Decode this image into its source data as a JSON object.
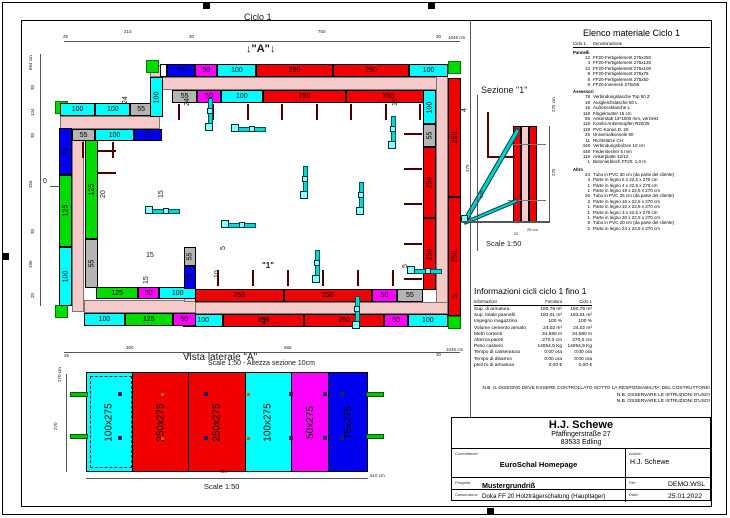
{
  "colors": {
    "red": "#f00000",
    "cyan": "#00ffff",
    "green": "#00dc00",
    "magenta": "#ff00ff",
    "blue": "#0000f0",
    "gray": "#b4b4b4",
    "white": "#ffffff"
  },
  "plan": {
    "title": "Ciclo 1",
    "bands": [
      {
        "x": 150,
        "y": 77,
        "w": 298,
        "h": 13
      },
      {
        "x": 436,
        "y": 65,
        "w": 12,
        "h": 252
      },
      {
        "x": 183,
        "y": 302,
        "w": 265,
        "h": 12
      },
      {
        "x": 72,
        "y": 116,
        "w": 12,
        "h": 196
      },
      {
        "x": 60,
        "y": 116,
        "w": 100,
        "h": 13
      },
      {
        "x": 84,
        "y": 300,
        "w": 112,
        "h": 13
      },
      {
        "x": 150,
        "y": 65,
        "w": 13,
        "h": 12
      },
      {
        "x": 184,
        "y": 289,
        "w": 12,
        "h": 13
      }
    ],
    "walls": [
      {
        "x": 160,
        "y": 64,
        "w": 288,
        "h": 13,
        "dir": "h",
        "segs": [
          {
            "s": 18,
            "c": "white",
            "t": ""
          },
          {
            "s": 75,
            "c": "blue",
            "t": "75"
          },
          {
            "s": 50,
            "c": "magenta",
            "t": "50"
          },
          {
            "s": 100,
            "c": "cyan",
            "t": "100"
          },
          {
            "s": 250,
            "c": "red",
            "t": "250"
          },
          {
            "s": 250,
            "c": "red",
            "t": "250"
          },
          {
            "s": 100,
            "c": "cyan",
            "t": "100"
          }
        ]
      },
      {
        "x": 172,
        "y": 90,
        "w": 258,
        "h": 13,
        "dir": "h",
        "segs": [
          {
            "s": 55,
            "c": "gray",
            "t": "55"
          },
          {
            "s": 50,
            "c": "magenta",
            "t": "50"
          },
          {
            "s": 100,
            "c": "cyan",
            "t": "100"
          },
          {
            "s": 250,
            "c": "red",
            "t": "250"
          },
          {
            "s": 250,
            "c": "red",
            "t": "250"
          }
        ]
      },
      {
        "x": 448,
        "y": 78,
        "w": 13,
        "h": 238,
        "dir": "v",
        "segs": [
          {
            "s": 250,
            "c": "red",
            "t": "250"
          },
          {
            "s": 250,
            "c": "red",
            "t": "250"
          }
        ]
      },
      {
        "x": 423,
        "y": 90,
        "w": 13,
        "h": 200,
        "dir": "v",
        "segs": [
          {
            "s": 100,
            "c": "cyan",
            "t": "100"
          },
          {
            "s": 55,
            "c": "gray",
            "t": "55"
          },
          {
            "s": 250,
            "c": "red",
            "t": "250"
          },
          {
            "s": 250,
            "c": "red",
            "t": "250"
          }
        ]
      },
      {
        "x": 195,
        "y": 289,
        "w": 228,
        "h": 13,
        "dir": "h",
        "segs": [
          {
            "s": 250,
            "c": "red",
            "t": "250"
          },
          {
            "s": 250,
            "c": "red",
            "t": "250"
          },
          {
            "s": 50,
            "c": "magenta",
            "t": "50"
          },
          {
            "s": 55,
            "c": "gray",
            "t": "55"
          }
        ]
      },
      {
        "x": 183,
        "y": 314,
        "w": 265,
        "h": 13,
        "dir": "h",
        "segs": [
          {
            "s": 100,
            "c": "cyan",
            "t": "100"
          },
          {
            "s": 250,
            "c": "red",
            "t": "250"
          },
          {
            "s": 250,
            "c": "red",
            "t": "250"
          },
          {
            "s": 50,
            "c": "magenta",
            "t": "50"
          },
          {
            "s": 100,
            "c": "cyan",
            "t": "100"
          }
        ]
      },
      {
        "x": 59,
        "y": 128,
        "w": 13,
        "h": 178,
        "dir": "v",
        "segs": [
          {
            "s": 75,
            "c": "blue",
            "t": "75"
          },
          {
            "s": 125,
            "c": "green",
            "t": "125"
          },
          {
            "s": 100,
            "c": "cyan",
            "t": "100"
          }
        ]
      },
      {
        "x": 85,
        "y": 140,
        "w": 13,
        "h": 148,
        "dir": "v",
        "segs": [
          {
            "s": 125,
            "c": "green",
            "t": "125"
          },
          {
            "s": 55,
            "c": "gray",
            "t": "55"
          }
        ]
      },
      {
        "x": 60,
        "y": 103,
        "w": 92,
        "h": 13,
        "dir": "h",
        "segs": [
          {
            "s": 100,
            "c": "cyan",
            "t": "100"
          },
          {
            "s": 100,
            "c": "cyan",
            "t": "100"
          },
          {
            "s": 55,
            "c": "gray",
            "t": "55"
          }
        ]
      },
      {
        "x": 72,
        "y": 129,
        "w": 90,
        "h": 12,
        "dir": "h",
        "segs": [
          {
            "s": 55,
            "c": "gray",
            "t": "55"
          },
          {
            "s": 100,
            "c": "cyan",
            "t": "100"
          },
          {
            "s": 75,
            "c": "blue",
            "t": "75"
          }
        ]
      },
      {
        "x": 96,
        "y": 287,
        "w": 100,
        "h": 12,
        "dir": "h",
        "segs": [
          {
            "s": 125,
            "c": "green",
            "t": "125"
          },
          {
            "s": 50,
            "c": "magenta",
            "t": "50"
          },
          {
            "s": 100,
            "c": "cyan",
            "t": "100"
          }
        ]
      },
      {
        "x": 84,
        "y": 313,
        "w": 112,
        "h": 13,
        "dir": "h",
        "segs": [
          {
            "s": 100,
            "c": "cyan",
            "t": "100"
          },
          {
            "s": 125,
            "c": "green",
            "t": "125"
          },
          {
            "s": 50,
            "c": "magenta",
            "t": "50"
          }
        ]
      },
      {
        "x": 150,
        "y": 77,
        "w": 13,
        "h": 40,
        "dir": "v",
        "segs": [
          {
            "s": 100,
            "c": "cyan",
            "t": "100"
          }
        ]
      },
      {
        "x": 184,
        "y": 247,
        "w": 12,
        "h": 42,
        "dir": "v",
        "segs": [
          {
            "s": 55,
            "c": "gray",
            "t": "55"
          },
          {
            "s": 75,
            "c": "blue",
            "t": "75"
          }
        ]
      }
    ],
    "corners": [
      [
        146,
        60
      ],
      [
        448,
        61
      ],
      [
        448,
        316
      ],
      [
        55,
        101
      ],
      [
        55,
        305
      ],
      [
        176,
        313
      ]
    ],
    "lines": [
      [
        64,
        41,
        396,
        1
      ],
      [
        40,
        54,
        1,
        252
      ],
      [
        64,
        352,
        396,
        1
      ],
      [
        50,
        186,
        14,
        1
      ],
      [
        66,
        374,
        1,
        98
      ],
      [
        86,
        478,
        282,
        1
      ],
      [
        470,
        20,
        1,
        397
      ],
      [
        477,
        95,
        1,
        156
      ],
      [
        549,
        126,
        1,
        96
      ],
      [
        458,
        221,
        92,
        1.5
      ]
    ]
  },
  "labels": [
    {
      "t": "Ciclo 1",
      "x": 244,
      "y": 13,
      "s": 9
    },
    {
      "t": "↓\"A\"↓",
      "x": 246,
      "y": 44,
      "s": 11,
      "b": 1
    },
    {
      "t": "25",
      "x": 63,
      "y": 35,
      "s": 4.5
    },
    {
      "t": "210",
      "x": 124,
      "y": 30,
      "s": 4.5
    },
    {
      "t": "30",
      "x": 189,
      "y": 35,
      "s": 4.5
    },
    {
      "t": "760",
      "x": 318,
      "y": 30,
      "s": 4.5
    },
    {
      "t": "30",
      "x": 436,
      "y": 35,
      "s": 4.5
    },
    {
      "t": "1045 cm",
      "x": 448,
      "y": 36,
      "s": 4.5
    },
    {
      "t": "684 cm",
      "x": 29,
      "y": 70,
      "s": 4.5,
      "r": 1
    },
    {
      "t": "30",
      "x": 31,
      "y": 90,
      "s": 4.5,
      "r": 1
    },
    {
      "t": "134",
      "x": 31,
      "y": 116,
      "s": 4.5,
      "r": 1
    },
    {
      "t": "30",
      "x": 31,
      "y": 138,
      "s": 4.5,
      "r": 1
    },
    {
      "t": "355",
      "x": 29,
      "y": 188,
      "s": 4.5,
      "r": 1
    },
    {
      "t": "30",
      "x": 31,
      "y": 234,
      "s": 4.5,
      "r": 1
    },
    {
      "t": "196",
      "x": 29,
      "y": 268,
      "s": 4.5,
      "r": 1
    },
    {
      "t": "20",
      "x": 31,
      "y": 298,
      "s": 4.5,
      "r": 1
    },
    {
      "t": "0",
      "x": 43,
      "y": 178,
      "s": 7
    },
    {
      "t": "24",
      "x": 122,
      "y": 104,
      "s": 7,
      "r": 1
    },
    {
      "t": "24",
      "x": 184,
      "y": 106,
      "s": 7,
      "r": 1
    },
    {
      "t": "19",
      "x": 392,
      "y": 106,
      "s": 7,
      "r": 1
    },
    {
      "t": "4",
      "x": 461,
      "y": 112,
      "s": 7,
      "r": 1
    },
    {
      "t": "20",
      "x": 100,
      "y": 198,
      "s": 7,
      "r": 1
    },
    {
      "t": "15",
      "x": 158,
      "y": 198,
      "s": 7,
      "r": 1
    },
    {
      "t": "15",
      "x": 146,
      "y": 252,
      "s": 7
    },
    {
      "t": "15",
      "x": 143,
      "y": 284,
      "s": 7,
      "r": 1
    },
    {
      "t": "10",
      "x": 214,
      "y": 278,
      "s": 7,
      "r": 1
    },
    {
      "t": "5",
      "x": 220,
      "y": 250,
      "s": 7,
      "r": 1
    },
    {
      "t": "5",
      "x": 402,
      "y": 268,
      "s": 7,
      "r": 1
    },
    {
      "t": "5",
      "x": 452,
      "y": 298,
      "s": 7,
      "r": 1
    },
    {
      "t": "\"1\"",
      "x": 262,
      "y": 262,
      "s": 8,
      "b": 1
    },
    {
      "t": "\"1\" →",
      "x": 258,
      "y": 318,
      "s": 8,
      "b": 1
    },
    {
      "t": "25",
      "x": 64,
      "y": 354,
      "s": 4.5
    },
    {
      "t": "300",
      "x": 126,
      "y": 346,
      "s": 4.5
    },
    {
      "t": "30",
      "x": 186,
      "y": 353,
      "s": 4.5
    },
    {
      "t": "665",
      "x": 284,
      "y": 346,
      "s": 4.5
    },
    {
      "t": "30",
      "x": 436,
      "y": 353,
      "s": 4.5
    },
    {
      "t": "1045 cm",
      "x": 446,
      "y": 348,
      "s": 4.5
    },
    {
      "t": "Sezione  \"1\"",
      "x": 481,
      "y": 86,
      "s": 9
    },
    {
      "t": "270",
      "x": 466,
      "y": 172,
      "s": 4.5,
      "r": 1
    },
    {
      "t": "629",
      "x": 480,
      "y": 198,
      "s": 4.5,
      "r": 1
    },
    {
      "t": "275 cm",
      "x": 552,
      "y": 112,
      "s": 4.5,
      "r": 1
    },
    {
      "t": "275",
      "x": 552,
      "y": 176,
      "s": 4.5,
      "r": 1
    },
    {
      "t": "22",
      "x": 514,
      "y": 232,
      "s": 4
    },
    {
      "t": "25 cm",
      "x": 527,
      "y": 228,
      "s": 4
    },
    {
      "t": "Scale 1:50",
      "x": 486,
      "y": 240,
      "s": 7.5
    },
    {
      "t": "Scale 1:50 - Altezza sezione 10cm",
      "x": 208,
      "y": 360,
      "s": 7
    },
    {
      "t": "Vista laterale \"A\"",
      "x": 183,
      "y": 353,
      "s": 10
    },
    {
      "t": "270 cm",
      "x": 58,
      "y": 382,
      "s": 4.5,
      "r": 1
    },
    {
      "t": "270",
      "x": 54,
      "y": 430,
      "s": 4.5,
      "r": 1
    },
    {
      "t": "610",
      "x": 220,
      "y": 470,
      "s": 4.5
    },
    {
      "t": "610 cm",
      "x": 370,
      "y": 474,
      "s": 4.5
    },
    {
      "t": "Scale 1:50",
      "x": 204,
      "y": 483,
      "s": 7.5
    }
  ],
  "side_view": {
    "panels": [
      {
        "label": "100x275",
        "c": "cyan",
        "s": 100
      },
      {
        "label": "250x275",
        "c": "red",
        "s": 250
      },
      {
        "label": "250x275",
        "c": "red",
        "s": 250
      },
      {
        "label": "100x275",
        "c": "cyan",
        "s": 100
      },
      {
        "label": "50x275",
        "c": "magenta",
        "s": 50
      },
      {
        "label": "75x275",
        "c": "blue",
        "s": 75
      }
    ]
  },
  "material_list": {
    "title": "Elenco materiale  Ciclo 1",
    "col1": "Ciclo 1",
    "col2": "Denominazione",
    "groups": [
      {
        "name": "Pannelli",
        "items": [
          {
            "qty": "12",
            "name": "FF20-Fertigelement 275x250"
          },
          {
            "qty": "4",
            "name": "FF20-Fertigelement 275x125"
          },
          {
            "qty": "13",
            "name": "FF20-Fertigelement 275x100"
          },
          {
            "qty": "9",
            "name": "FF20-Fertigelement 275x75"
          },
          {
            "qty": "8",
            "name": "FF20-Fertigelement 275x50"
          },
          {
            "qty": "8",
            "name": "FF20-Inneneck 275x55"
          }
        ]
      },
      {
        "name": "Assessori",
        "items": [
          {
            "qty": "78",
            "name": "Verbindungslasche Top 50 Z"
          },
          {
            "qty": "18",
            "name": "Ausgleichslasche 50 L"
          },
          {
            "qty": "16",
            "name": "Außenecklasche L"
          },
          {
            "qty": "118",
            "name": "Flügelmutter 15 cm"
          },
          {
            "qty": "59",
            "name": "Ankerstab 15*1000 mm, verzinkt"
          },
          {
            "qty": "118",
            "name": "Kombi-Ankerstopfen R20/25"
          },
          {
            "qty": "118",
            "name": "PVC-Konus D. 20"
          },
          {
            "qty": "25",
            "name": "Universalkonsole 90"
          },
          {
            "qty": "11",
            "name": "Richtstütze CH"
          },
          {
            "qty": "448",
            "name": "Verbindungsbolzen 10 cm"
          },
          {
            "qty": "448",
            "name": "Federstecker 5 mm"
          },
          {
            "qty": "118",
            "name": "Ankerplatte 12/12"
          },
          {
            "qty": "1",
            "name": "Betonierblech FF20, 1,0 m"
          }
        ]
      },
      {
        "name": "Altro",
        "items": [
          {
            "qty": "24",
            "name": "Tubo in PVC 30 cm (da parte del cliente)"
          },
          {
            "qty": "4",
            "name": "Parte in legno 5 x 22,5 x 270 cm"
          },
          {
            "qty": "1",
            "name": "Parte in legno 4 x 22,5 x 270 cm"
          },
          {
            "qty": "1",
            "name": "Parte in legno 19 x 22,5 x 270 cm"
          },
          {
            "qty": "26",
            "name": "Tubo in PVC 25 cm (da parte del cliente)"
          },
          {
            "qty": "3",
            "name": "Parte in legno 16 x 22,5 x 270 cm"
          },
          {
            "qty": "1",
            "name": "Parte in legno 10 x 22,5 x 270 cm"
          },
          {
            "qty": "1",
            "name": "Parte in legno 3 x 22,5 x 270 cm"
          },
          {
            "qty": "1",
            "name": "Parte in legno 20 x 22,5 x 270 cm"
          },
          {
            "qty": "8",
            "name": "Tubo in PVC 20 cm (da parte del cliente)"
          },
          {
            "qty": "2",
            "name": "Parte in legno 24 x 22,5 x 270 cm"
          }
        ]
      }
    ]
  },
  "info_table": {
    "title": "Informazioni cicli  ciclo 1 fino 1",
    "columns": [
      "Informazioni",
      "Fornitura",
      "Ciclo 1"
    ],
    "rows": [
      {
        "label": "Sup. di armatura",
        "fornitura": "180,79 m²",
        "ciclo": "180,79 m²"
      },
      {
        "label": "Sup. totale pannelli",
        "fornitura": "183,01 m²",
        "ciclo": "183,01 m²"
      },
      {
        "label": "Impegno magazzino",
        "fornitura": "100 %",
        "ciclo": "100 %"
      },
      {
        "label": "Volume cemento armato",
        "fornitura": "24,02 m³",
        "ciclo": "24,02 m³"
      },
      {
        "label": "Metri correnti",
        "fornitura": "34,580 m",
        "ciclo": "34,580 m"
      },
      {
        "label": "Altezza pareti",
        "fornitura": "270,0 cm",
        "ciclo": "270,0 cm"
      },
      {
        "label": "Peso cassero",
        "fornitura": "14054,9 Kg",
        "ciclo": "14054,9 Kg"
      },
      {
        "label": "Tempo di casseratura",
        "fornitura": "0:00 ora",
        "ciclo": "0:00 ora"
      },
      {
        "label": "Tempo di disarmo",
        "fornitura": "0:00 ora",
        "ciclo": "0:00 ora"
      },
      {
        "label": "prezzo di armatura",
        "fornitura": "0,00 €",
        "ciclo": "0,00 €"
      }
    ]
  },
  "notes": [
    "N.B. IL DISEGNO DEVE ESSERE CONTROLLATO SOTTO LA RESPONSABILITA' DEL COSTRUTTORE!",
    "N.B. OSSERVARE LE ISTRUZIONI D'USO!",
    "N.B. OSSERVARE LE ISTRUZIONI D'USO!"
  ],
  "title_block": {
    "company": "H.J. Schewe",
    "address1": "Pfaffingerstraße 27",
    "address2": "83533 Edling",
    "committente_label": "Committente:",
    "committente": "EuroSchal Homepage",
    "autore_label": "Autore:",
    "autore": "H.J. Schewe",
    "progetto_label": "Progetto:",
    "progetto": "Mustergrundriß",
    "file_label": "File:",
    "file": "DEMO.WSL",
    "casseratura_label": "Casseratura:",
    "casseratura": "Doka FF 20 Holzträgerschalung (Hauptlager)",
    "data_label": "Data:",
    "data": "25.01.2022"
  }
}
